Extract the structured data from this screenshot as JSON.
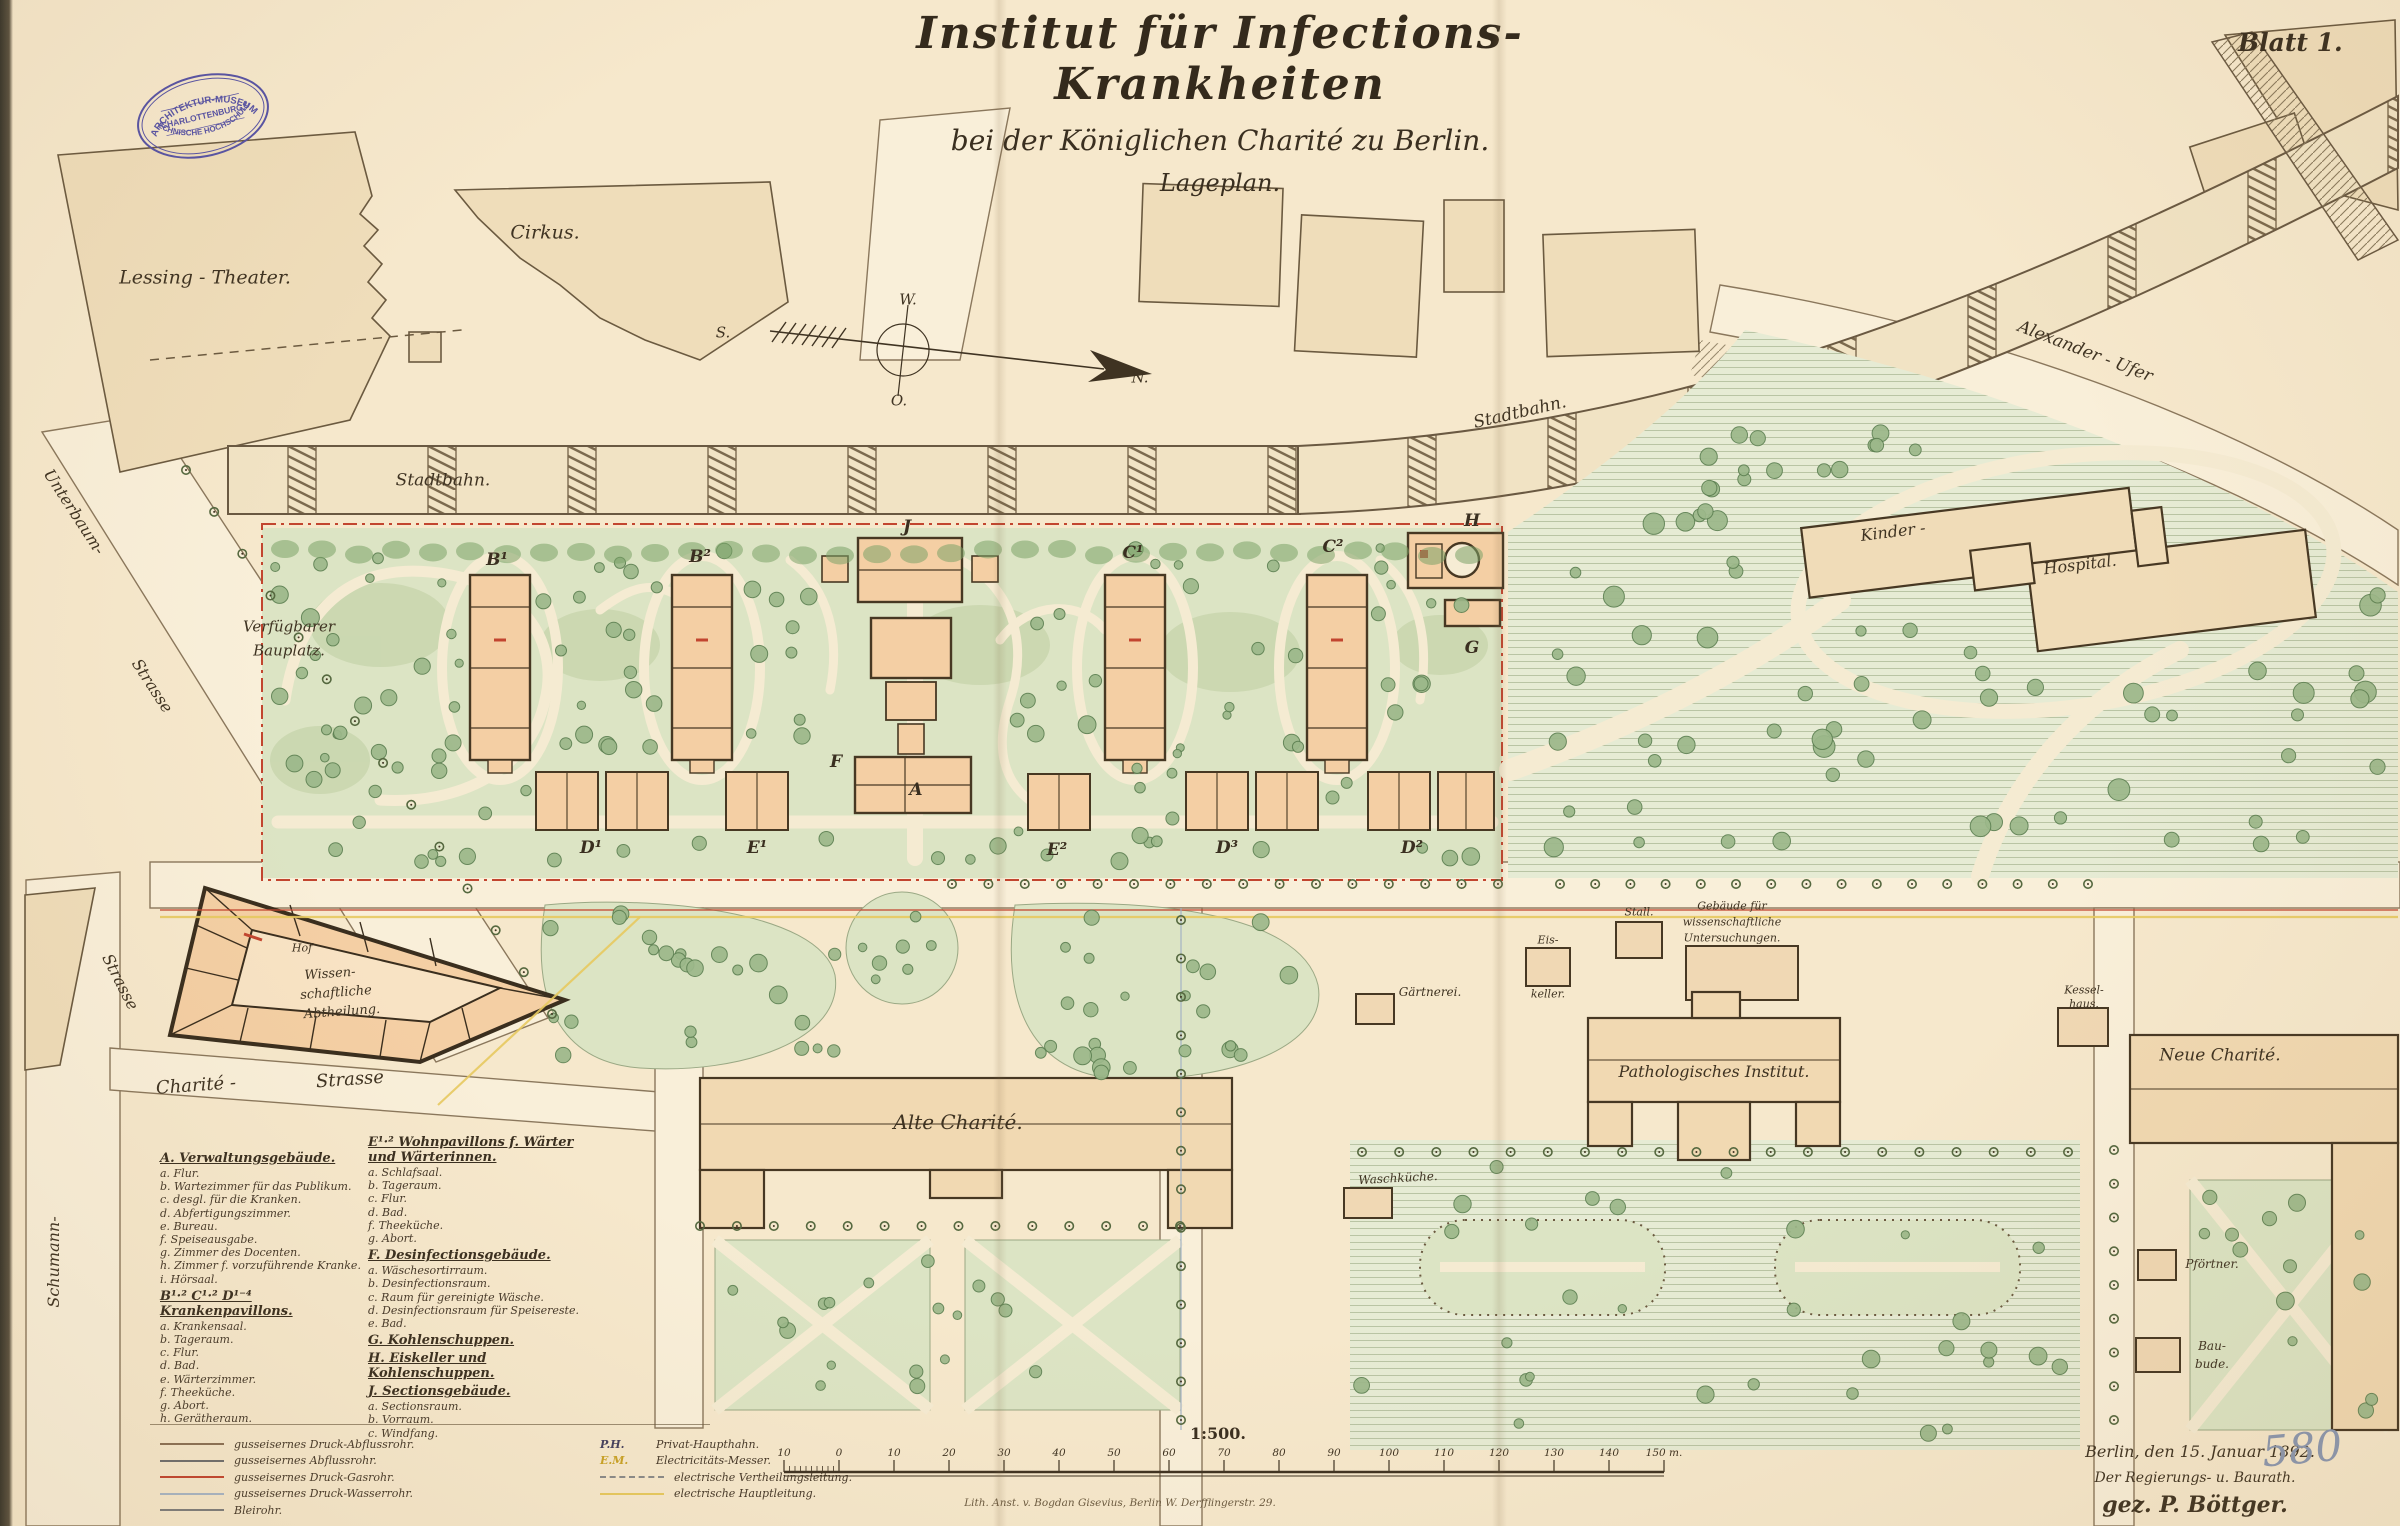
{
  "title": {
    "line1": "Institut für Infections-Krankheiten",
    "line2": "bei der Königlichen Charité zu Berlin.",
    "line3": "Lageplan."
  },
  "sheet_no": "Blatt 1.",
  "stamp": {
    "top": "ARCHITEKTUR-MUSEUM",
    "middle": "CHARLOTTENBURG.",
    "bottom": "TECHNISCHE HOCHSCHULE."
  },
  "compass": {
    "n": "N.",
    "s": "S.",
    "w": "W.",
    "o": "O."
  },
  "labels": {
    "lessing_theater": "Lessing - Theater.",
    "cirkus": "Cirkus.",
    "stadtbahn_w": "Stadtbahn.",
    "stadtbahn_e": "Stadtbahn.",
    "alexander_ufer": "Alexander - Ufer",
    "unterbaum": "Unterbaum-",
    "unterbaum_strasse": "Strasse",
    "strasse_w": "Strasse",
    "schumann": "Schumann-",
    "charite_str_1": "Charité -",
    "charite_str_2": "Strasse",
    "verfuegbarer": "Verfügbarer",
    "bauplatz": "Bauplatz.",
    "kinder": "Kinder -",
    "hospital": "Hospital.",
    "alte_charite": "Alte Charité.",
    "neue_charite": "Neue Charité.",
    "patholog": "Pathologisches Institut.",
    "wiss_unters_1": "Gebäude für",
    "wiss_unters_2": "wissenschaftliche",
    "wiss_unters_3": "Untersuchungen.",
    "gaertnerei": "Gärtnerei.",
    "eiskeller_1": "Eis-",
    "eiskeller_2": "keller.",
    "stall": "Stall.",
    "waschkueche": "Waschküche.",
    "kesselhaus_1": "Kessel-",
    "kesselhaus_2": "haus.",
    "pfoertner": "Pförtner.",
    "baubude_1": "Bau-",
    "baubude_2": "bude.",
    "hof": "Hof",
    "wiss_abt_1": "Wissen-",
    "wiss_abt_2": "schaftliche",
    "wiss_abt_3": "Abtheilung."
  },
  "plan_letters": [
    {
      "t": "B¹",
      "x": 497,
      "y": 560
    },
    {
      "t": "B²",
      "x": 700,
      "y": 557
    },
    {
      "t": "J",
      "x": 907,
      "y": 527
    },
    {
      "t": "C¹",
      "x": 1133,
      "y": 553
    },
    {
      "t": "C²",
      "x": 1333,
      "y": 547
    },
    {
      "t": "H",
      "x": 1472,
      "y": 521
    },
    {
      "t": "A",
      "x": 916,
      "y": 790
    },
    {
      "t": "F",
      "x": 836,
      "y": 762
    },
    {
      "t": "G",
      "x": 1472,
      "y": 648
    },
    {
      "t": "D¹",
      "x": 591,
      "y": 848
    },
    {
      "t": "E¹",
      "x": 757,
      "y": 848
    },
    {
      "t": "E²",
      "x": 1057,
      "y": 850
    },
    {
      "t": "D³",
      "x": 1227,
      "y": 848
    },
    {
      "t": "D²",
      "x": 1412,
      "y": 848
    }
  ],
  "legend": {
    "col1": [
      {
        "heading": "A. Verwaltungsgebäude.",
        "items": [
          "a. Flur.",
          "b. Wartezimmer für das Publikum.",
          "c. desgl. für die Kranken.",
          "d. Abfertigungszimmer.",
          "e. Bureau.",
          "f. Speiseausgabe.",
          "g. Zimmer des Docenten.",
          "h. Zimmer f. vorzuführende Kranke.",
          "i. Hörsaal."
        ]
      },
      {
        "heading": "B¹·² C¹·² D¹⁻⁴ Krankenpavillons.",
        "items": [
          "a. Krankensaal.",
          "b. Tageraum.",
          "c. Flur.",
          "d. Bad.",
          "e. Wärterzimmer.",
          "f. Theeküche.",
          "g. Abort.",
          "h. Gerätheraum."
        ]
      }
    ],
    "col2": [
      {
        "heading": "E¹·² Wohnpavillons f. Wärter und Wärterinnen.",
        "items": [
          "a. Schlafsaal.",
          "b. Tageraum.",
          "c. Flur.",
          "d. Bad.",
          "f. Theeküche.",
          "g. Abort."
        ]
      },
      {
        "heading": "F. Desinfectionsgebäude.",
        "items": [
          "a. Wäschesortirraum.",
          "b. Desinfectionsraum.",
          "c. Raum für gereinigte Wäsche.",
          "d. Desinfectionsraum für Speisereste.",
          "e. Bad."
        ]
      },
      {
        "heading": "G. Kohlenschuppen.",
        "items": []
      },
      {
        "heading": "H. Eiskeller und Kohlenschuppen.",
        "items": []
      },
      {
        "heading": "J. Sectionsgebäude.",
        "items": [
          "a. Sectionsraum.",
          "b. Vorraum.",
          "c. Windfang."
        ]
      }
    ],
    "key_left": [
      {
        "color": "#8a7055",
        "style": "solid",
        "label": "gusseisernes Druck-Abflussrohr."
      },
      {
        "color": "#6e6e6e",
        "style": "solid",
        "label": "gusseisernes Abflussrohr."
      },
      {
        "color": "#c2452f",
        "style": "solid",
        "label": "gusseisernes Druck-Gasrohr."
      },
      {
        "color": "#a8b6c6",
        "style": "solid",
        "label": "gusseisernes Druck-Wasserrohr."
      },
      {
        "color": "#7d7d7d",
        "style": "solid",
        "label": "Bleirohr."
      }
    ],
    "key_right": [
      {
        "symbol": "P.H.",
        "style": "text",
        "color": "#44405e",
        "label": "Privat-Haupthahn."
      },
      {
        "symbol": "E.M.",
        "style": "text",
        "color": "#c9a227",
        "label": "Electricitäts-Messer."
      },
      {
        "symbol": "",
        "style": "dashed",
        "color": "#8a8a8a",
        "label": "electrische Vertheilungsleitung."
      },
      {
        "symbol": "",
        "style": "solid",
        "color": "#e7c95f",
        "label": "electrische Hauptleitung."
      }
    ]
  },
  "scale": {
    "ratio": "1:500.",
    "ticks": [
      "10",
      "0",
      "10",
      "20",
      "30",
      "40",
      "50",
      "60",
      "70",
      "80",
      "90",
      "100",
      "110",
      "120",
      "130",
      "140",
      "150 m."
    ]
  },
  "footer": {
    "imprint": "Lith. Anst. v. Bogdan Gisevius, Berlin W. Derfflingerstr. 29.",
    "date": "Berlin, den 15. Januar 1892.",
    "role": "Der Regierungs- u. Baurath.",
    "signature": "gez. P. Böttger.",
    "number": "580"
  },
  "colors": {
    "paper": "#f6e8cc",
    "ink": "#3f3322",
    "accent_red": "#c2452f",
    "accent_yellow": "#e7c95f",
    "stamp": "#5753a5",
    "garden_green": "#dce4c4",
    "park_green": "#e6ebd4",
    "building_peach": "#f4cfa4"
  }
}
